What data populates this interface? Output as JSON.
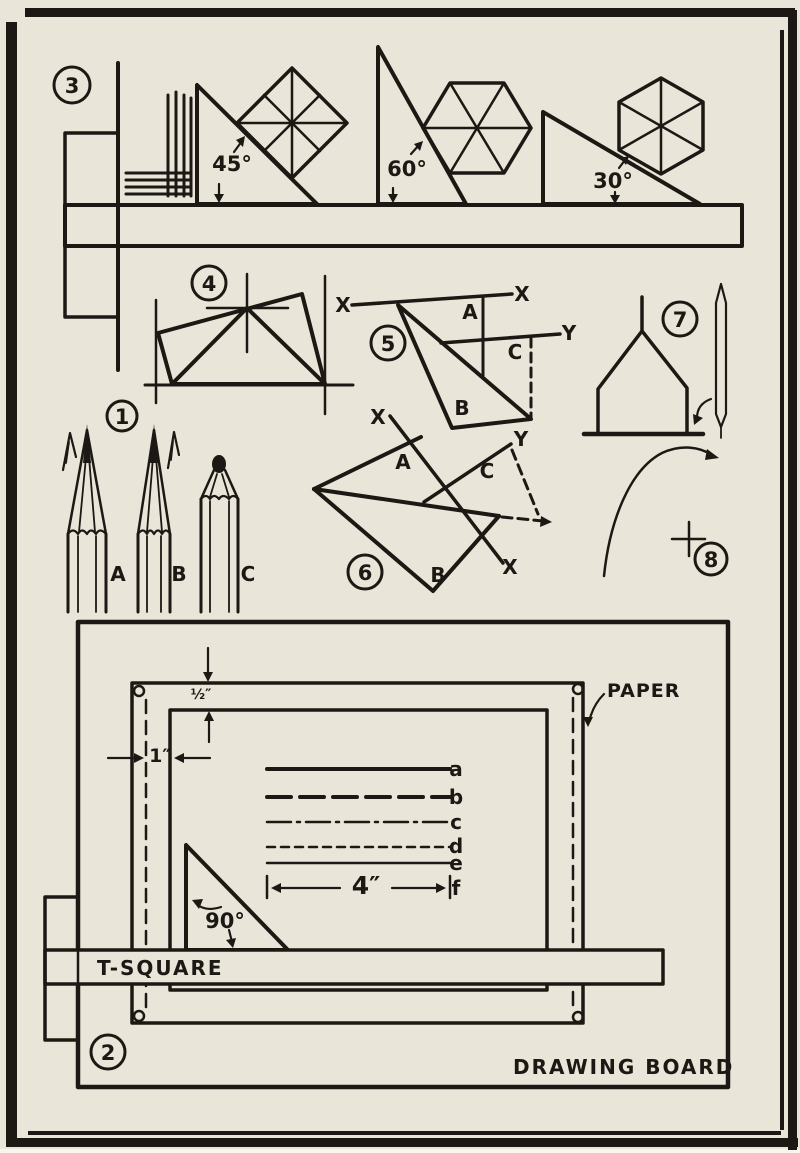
{
  "palette": {
    "paper": "#e9e5d9",
    "ink": "#1c1914"
  },
  "figure1": {
    "number": "1",
    "pencil_a": "A",
    "pencil_b": "B",
    "pencil_c": "C"
  },
  "figure2": {
    "number": "2",
    "tsquare": "T-SQUARE",
    "paper": "PAPER",
    "drawing_board": "DRAWING BOARD",
    "angle": "90°",
    "dim_half": "½″",
    "dim_one": "1″",
    "dim_four": "4″",
    "line_a": "a",
    "line_b": "b",
    "line_c": "c",
    "line_d": "d",
    "line_e": "e",
    "line_f": "f"
  },
  "figure3": {
    "number": "3",
    "angle45": "45°",
    "angle60": "60°",
    "angle30": "30°"
  },
  "figure4": {
    "number": "4"
  },
  "figure5": {
    "number": "5",
    "x_left": "X",
    "x_right": "X",
    "y": "Y",
    "a": "A",
    "b": "B",
    "c": "C"
  },
  "figure6": {
    "number": "6",
    "x_top": "X",
    "x_bottom": "X",
    "y": "Y",
    "a": "A",
    "b": "B",
    "c": "C"
  },
  "figure7": {
    "number": "7"
  },
  "figure8": {
    "number": "8"
  }
}
